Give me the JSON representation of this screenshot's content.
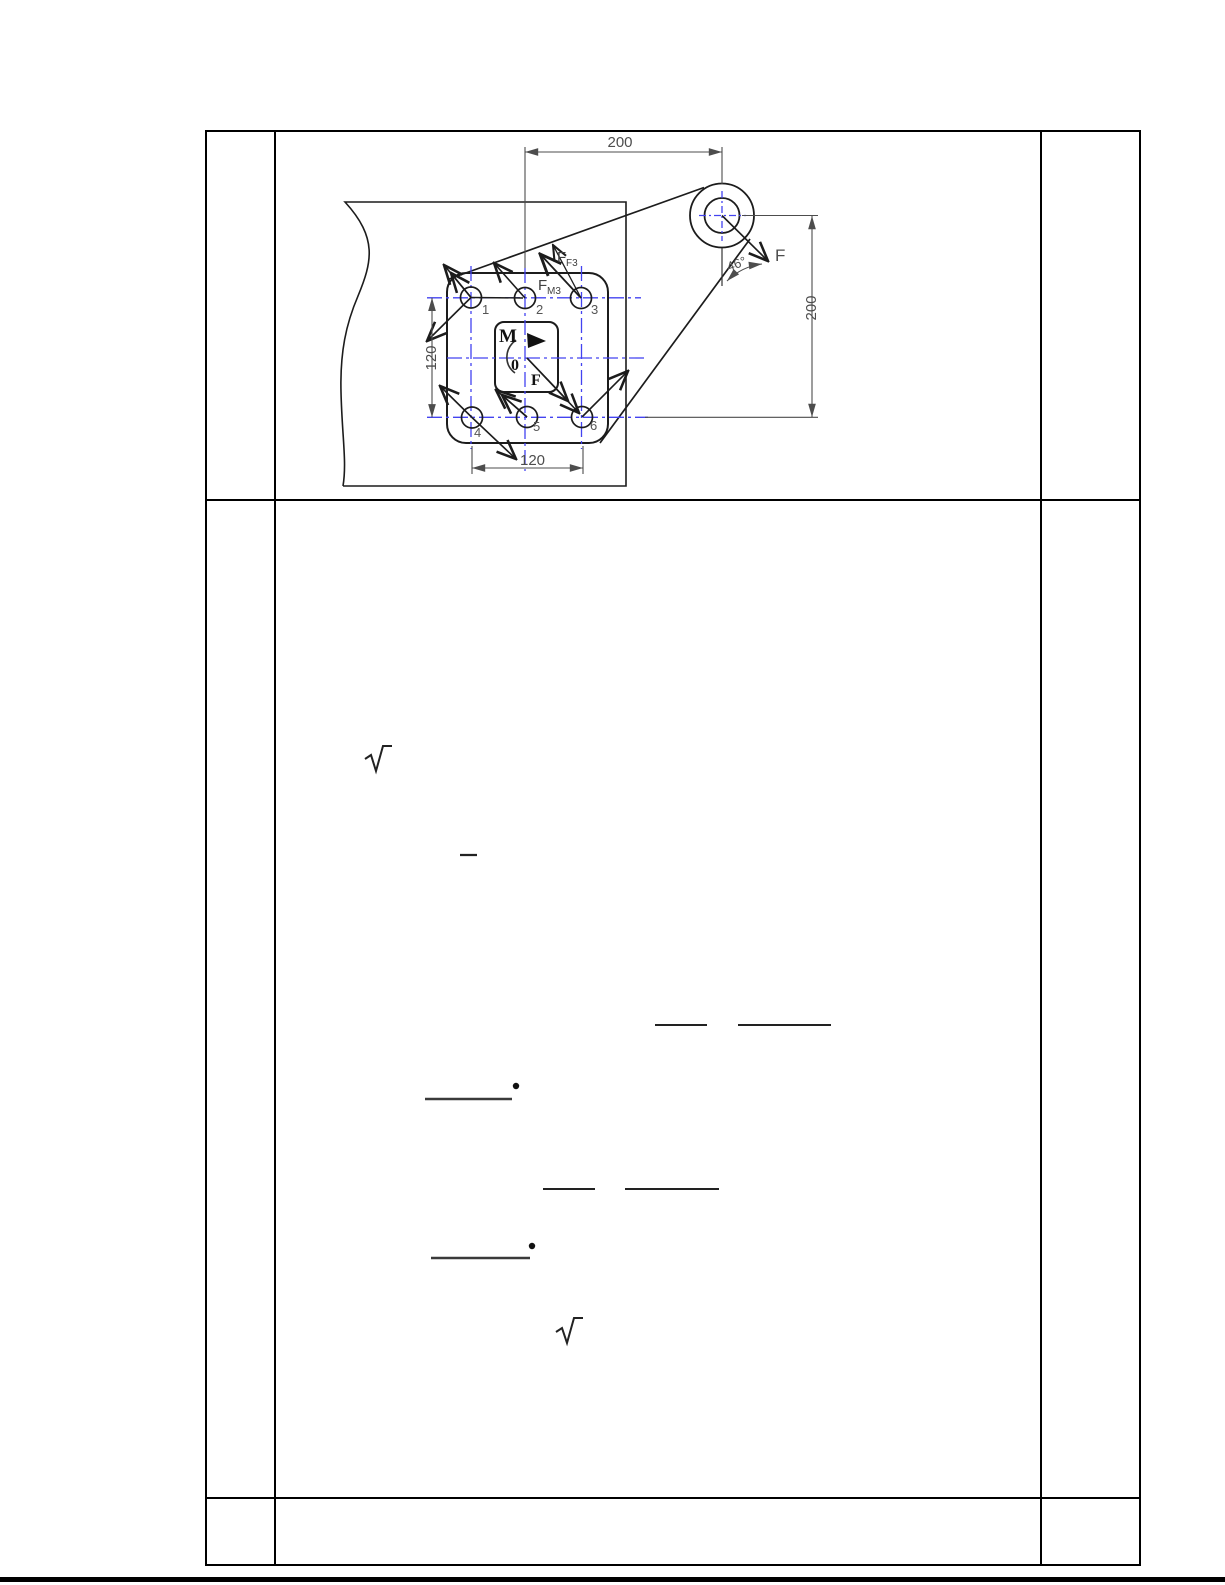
{
  "document": {
    "type": "engineering-solution-sheet",
    "colors": {
      "table_border": "#000000",
      "centerline_blue": "#4343f0",
      "drawing_line": "#1c1c1c",
      "dim_gray": "#4d4d4d"
    }
  },
  "drawing": {
    "dimensions": {
      "top": "200",
      "right": "200",
      "left": "120",
      "bottom": "120"
    },
    "angle_label": "46°",
    "external_force_label": "F",
    "bolts": [
      "1",
      "2",
      "3",
      "4",
      "5",
      "6"
    ],
    "force_labels": {
      "ff3_main": "F",
      "ff3_sub": "F3",
      "fm3_main": "F",
      "fm3_sub": "M3",
      "moment": "M",
      "origin": "0",
      "center_force": "F"
    }
  },
  "solution": {
    "symbols": [
      "radical",
      "minus",
      "fraction-bar",
      "fraction-bar",
      "underline",
      "dot",
      "fraction-bar",
      "fraction-bar",
      "underline",
      "dot",
      "radical"
    ]
  }
}
